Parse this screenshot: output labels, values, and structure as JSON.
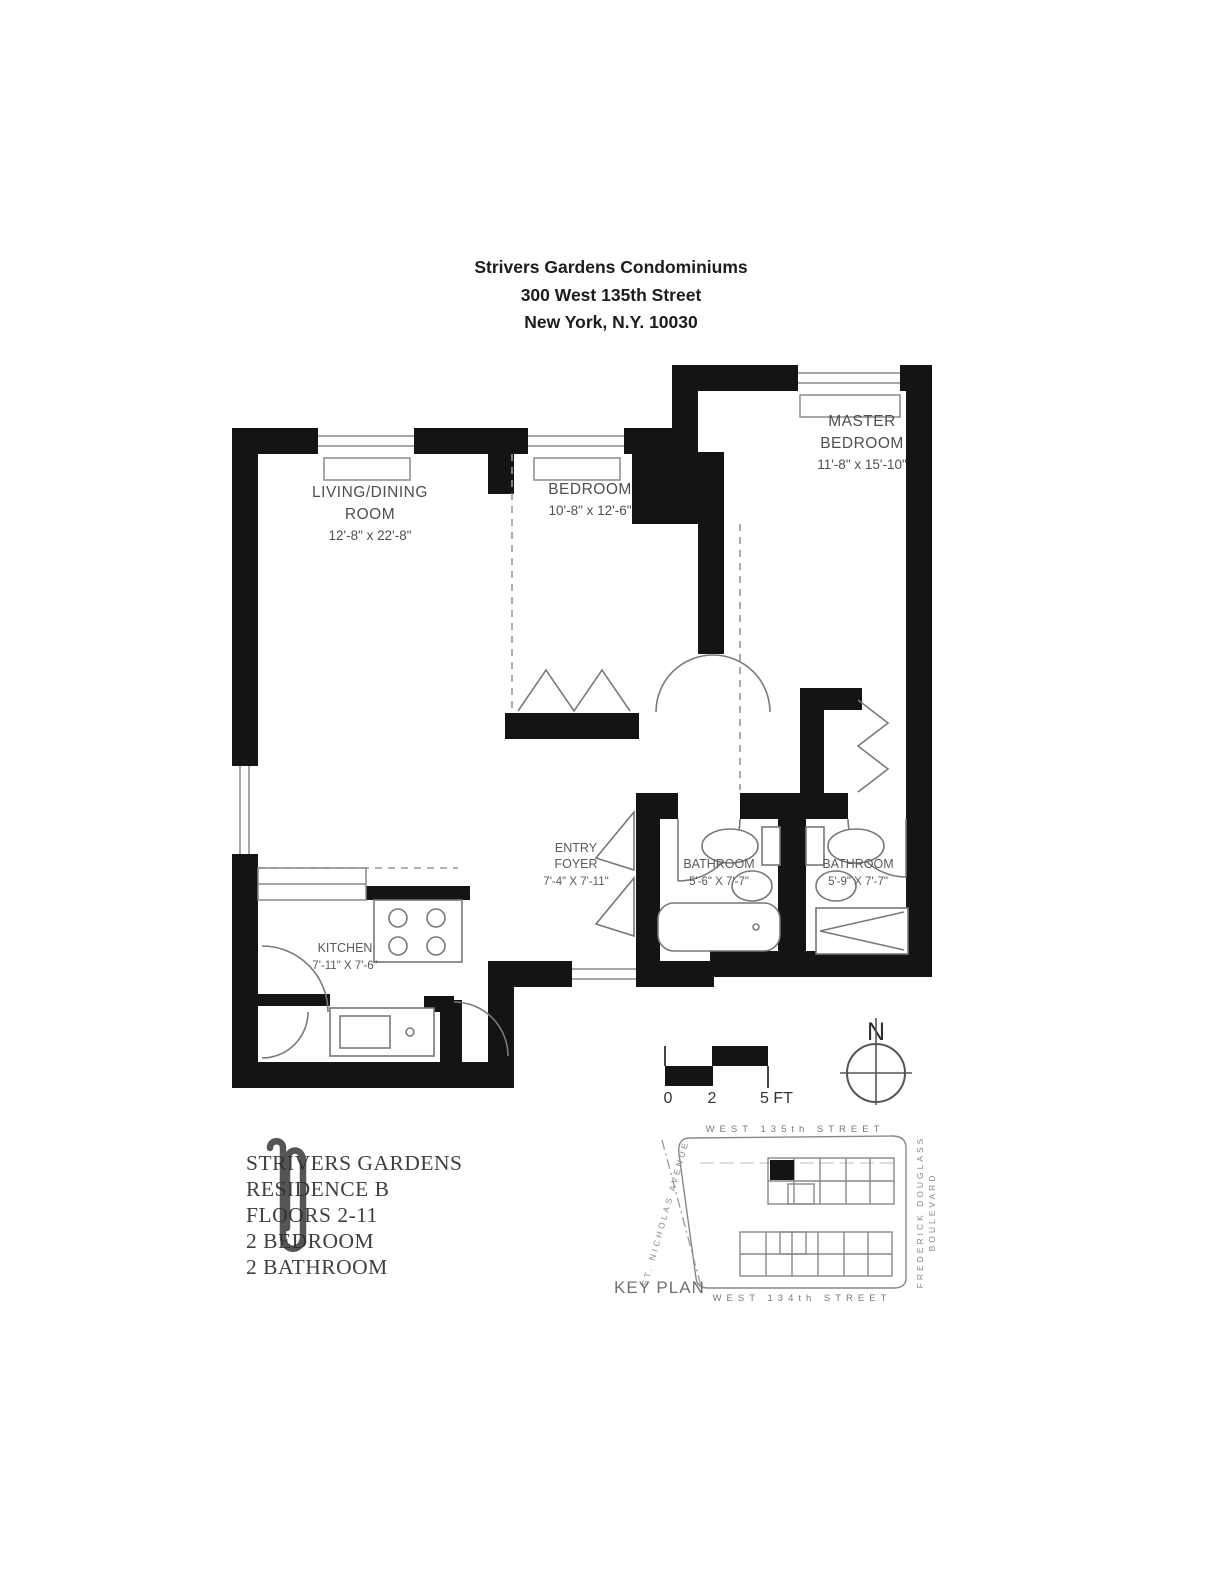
{
  "title": {
    "line1": "Strivers Gardens Condominiums",
    "line2": "300 West 135th Street",
    "line3": "New York, N.Y. 10030"
  },
  "rooms": {
    "living": {
      "line1": "LIVING/DINING",
      "line2": "ROOM",
      "dims": "12'-8\" x 22'-8\""
    },
    "bedroom": {
      "line1": "BEDROOM",
      "dims": "10'-8\" x 12'-6\""
    },
    "master": {
      "line1": "MASTER",
      "line2": "BEDROOM",
      "dims": "11'-8\" x 15'-10\""
    },
    "kitchen": {
      "line1": "KITCHEN",
      "dims": "7'-11\" X 7'-6\""
    },
    "entry": {
      "line1": "ENTRY",
      "line2": "FOYER",
      "dims": "7'-4\" X 7'-11\""
    },
    "bath1": {
      "line1": "BATHROOM",
      "dims": "5'-6\" X 7'-7\""
    },
    "bath2": {
      "line1": "BATHROOM",
      "dims": "5'-9\" X 7'-7\""
    }
  },
  "scale_bar": {
    "label_0": "0",
    "label_2": "2",
    "label_5": "5 FT"
  },
  "compass": {
    "label": "N"
  },
  "key_plan": {
    "label": "KEY PLAN",
    "street_top": "WEST 135th STREET",
    "street_bottom": "WEST 134th STREET",
    "street_right_line1": "FREDERICK DOUGLASS",
    "street_right_line2": "BOULEVARD",
    "street_left": "ST. NICHOLAS AVENUE"
  },
  "unit_info": {
    "line1": "STRIVERS GARDENS",
    "line2": "RESIDENCE B",
    "line3": "FLOORS 2-11",
    "line4": "2 BEDROOM",
    "line5": "2 BATHROOM"
  },
  "colors": {
    "wall": "#141414",
    "label": "#4f4f4f",
    "fixture": "#777777",
    "keyplan": "#787878"
  }
}
